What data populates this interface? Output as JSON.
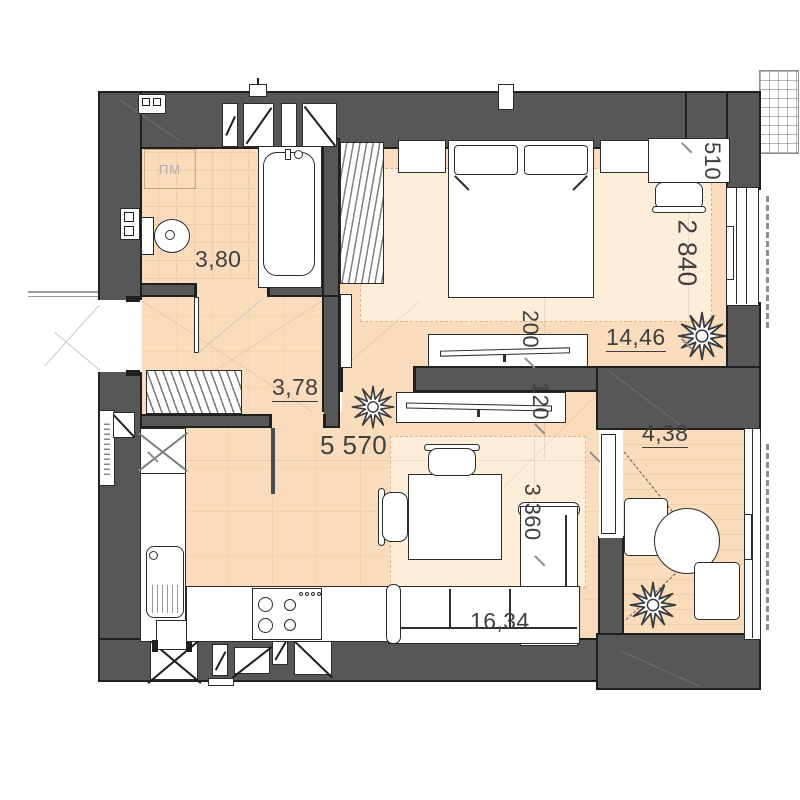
{
  "plan": {
    "title": "one-bedroom-apartment-floor-plan",
    "rooms": [
      {
        "name": "bathroom",
        "area": "3,80"
      },
      {
        "name": "hallway",
        "area": "3,78"
      },
      {
        "name": "bedroom",
        "area": "14,46"
      },
      {
        "name": "kitchen-living-room",
        "area": "16,34"
      },
      {
        "name": "balcony",
        "area": "4,38"
      }
    ],
    "dims": [
      {
        "name": "living-width-mm",
        "value": "5 570"
      },
      {
        "name": "bedroom-depth-mm",
        "value": "2 840"
      },
      {
        "name": "desk-depth-mm",
        "value": "510"
      },
      {
        "name": "bedroom-tv-depth-mm",
        "value": "200"
      },
      {
        "name": "living-tv-depth-mm",
        "value": "120"
      },
      {
        "name": "living-depth-mm",
        "value": "3 360"
      }
    ],
    "labels": {
      "washer": "ПМ"
    },
    "colors": {
      "wall": "#575757",
      "floor": "#f9dcbb",
      "carpet": "#fdeeda",
      "outline": "#1f1f1f"
    }
  }
}
